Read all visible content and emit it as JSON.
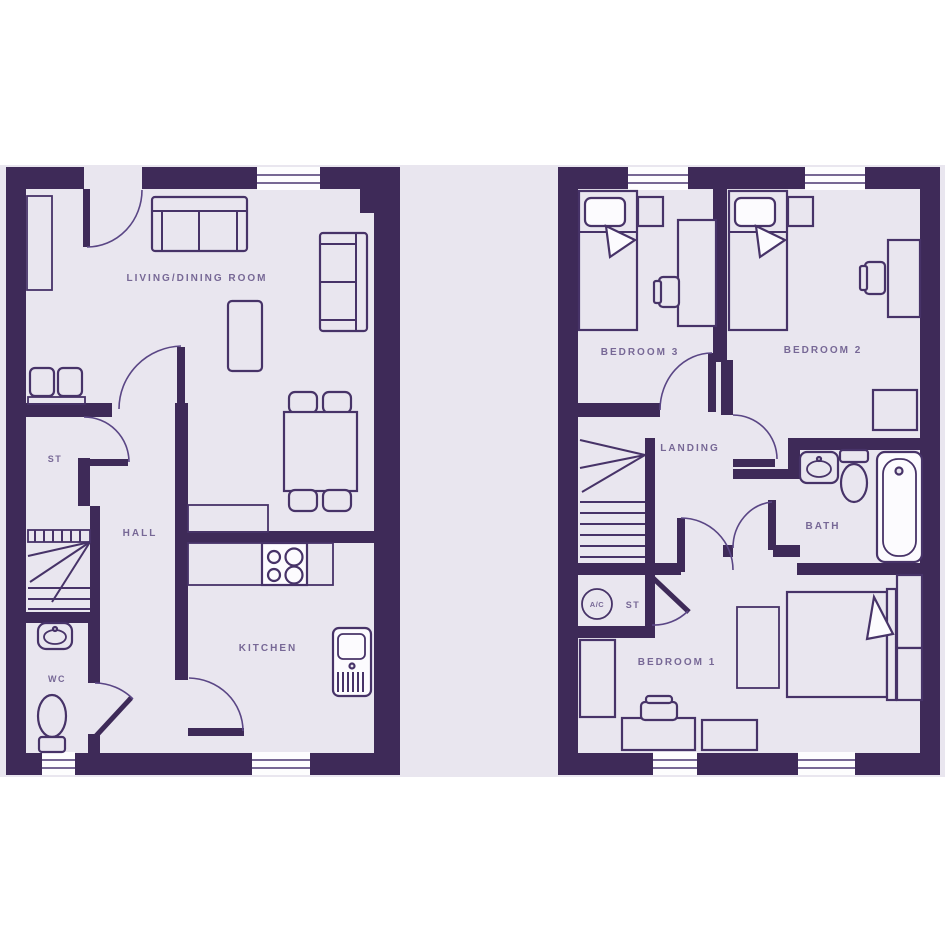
{
  "palette": {
    "wall": "#3e2a58",
    "floor": "#e9e6ef",
    "furniture_line": "#473368",
    "window": "#fdfdfe",
    "label_text": "#776896",
    "page_background": "#ffffff"
  },
  "ground_floor": {
    "labels": {
      "living_dining": "LIVING/DINING ROOM",
      "storage": "ST",
      "hall": "HALL",
      "wc": "WC",
      "kitchen": "KITCHEN"
    }
  },
  "first_floor": {
    "labels": {
      "bedroom3": "BEDROOM 3",
      "bedroom2": "BEDROOM 2",
      "landing": "LANDING",
      "bath": "BATH",
      "bedroom1": "BEDROOM 1",
      "airing_cupboard": "A/C",
      "storage": "ST"
    }
  }
}
